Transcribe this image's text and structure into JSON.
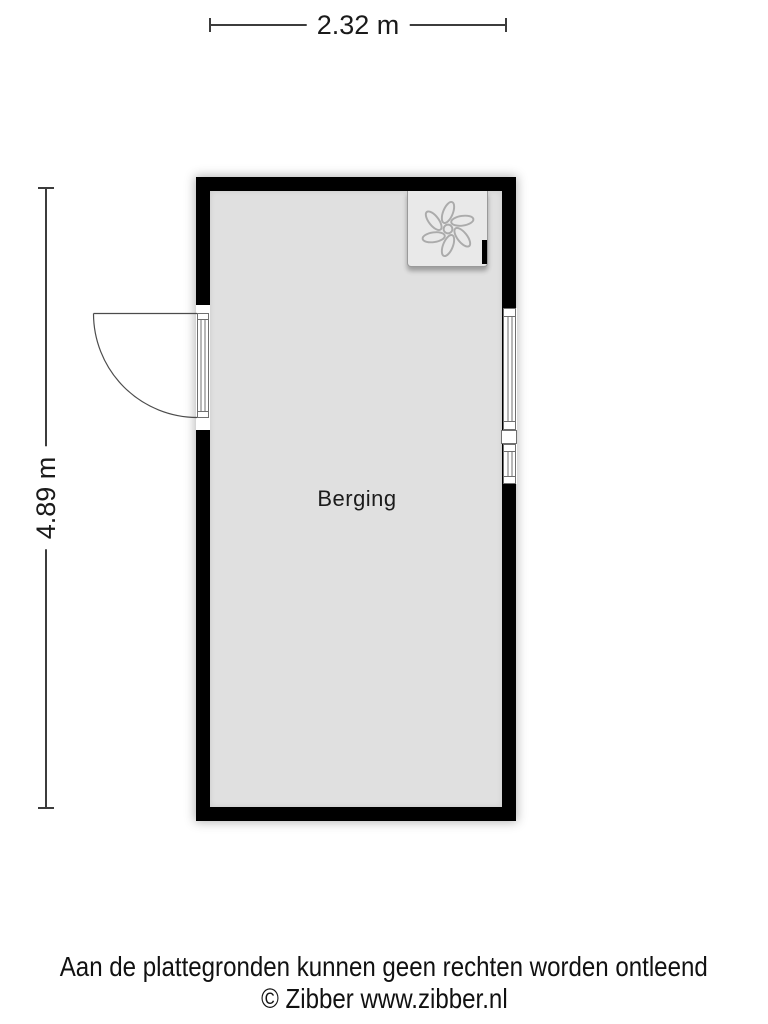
{
  "dimensions": {
    "width": {
      "label": "2.32 m"
    },
    "height": {
      "label": "4.89 m"
    }
  },
  "room": {
    "name": "Berging"
  },
  "fixtures": {
    "fan": "fan-icon",
    "door": "door-swing-left",
    "window_count": 2
  },
  "footer": {
    "disclaimer": "Aan de plattegronden kunnen geen rechten worden ontleend",
    "copyright": "© Zibber www.zibber.nl"
  },
  "colors": {
    "wall": "#000000",
    "floor": "#e0e0e0",
    "fan_box": "#e9e9e9",
    "frame_line": "#6f6f6f",
    "dimension_line": "#3c3c3c",
    "text": "#1a1a1a",
    "background": "#ffffff"
  }
}
